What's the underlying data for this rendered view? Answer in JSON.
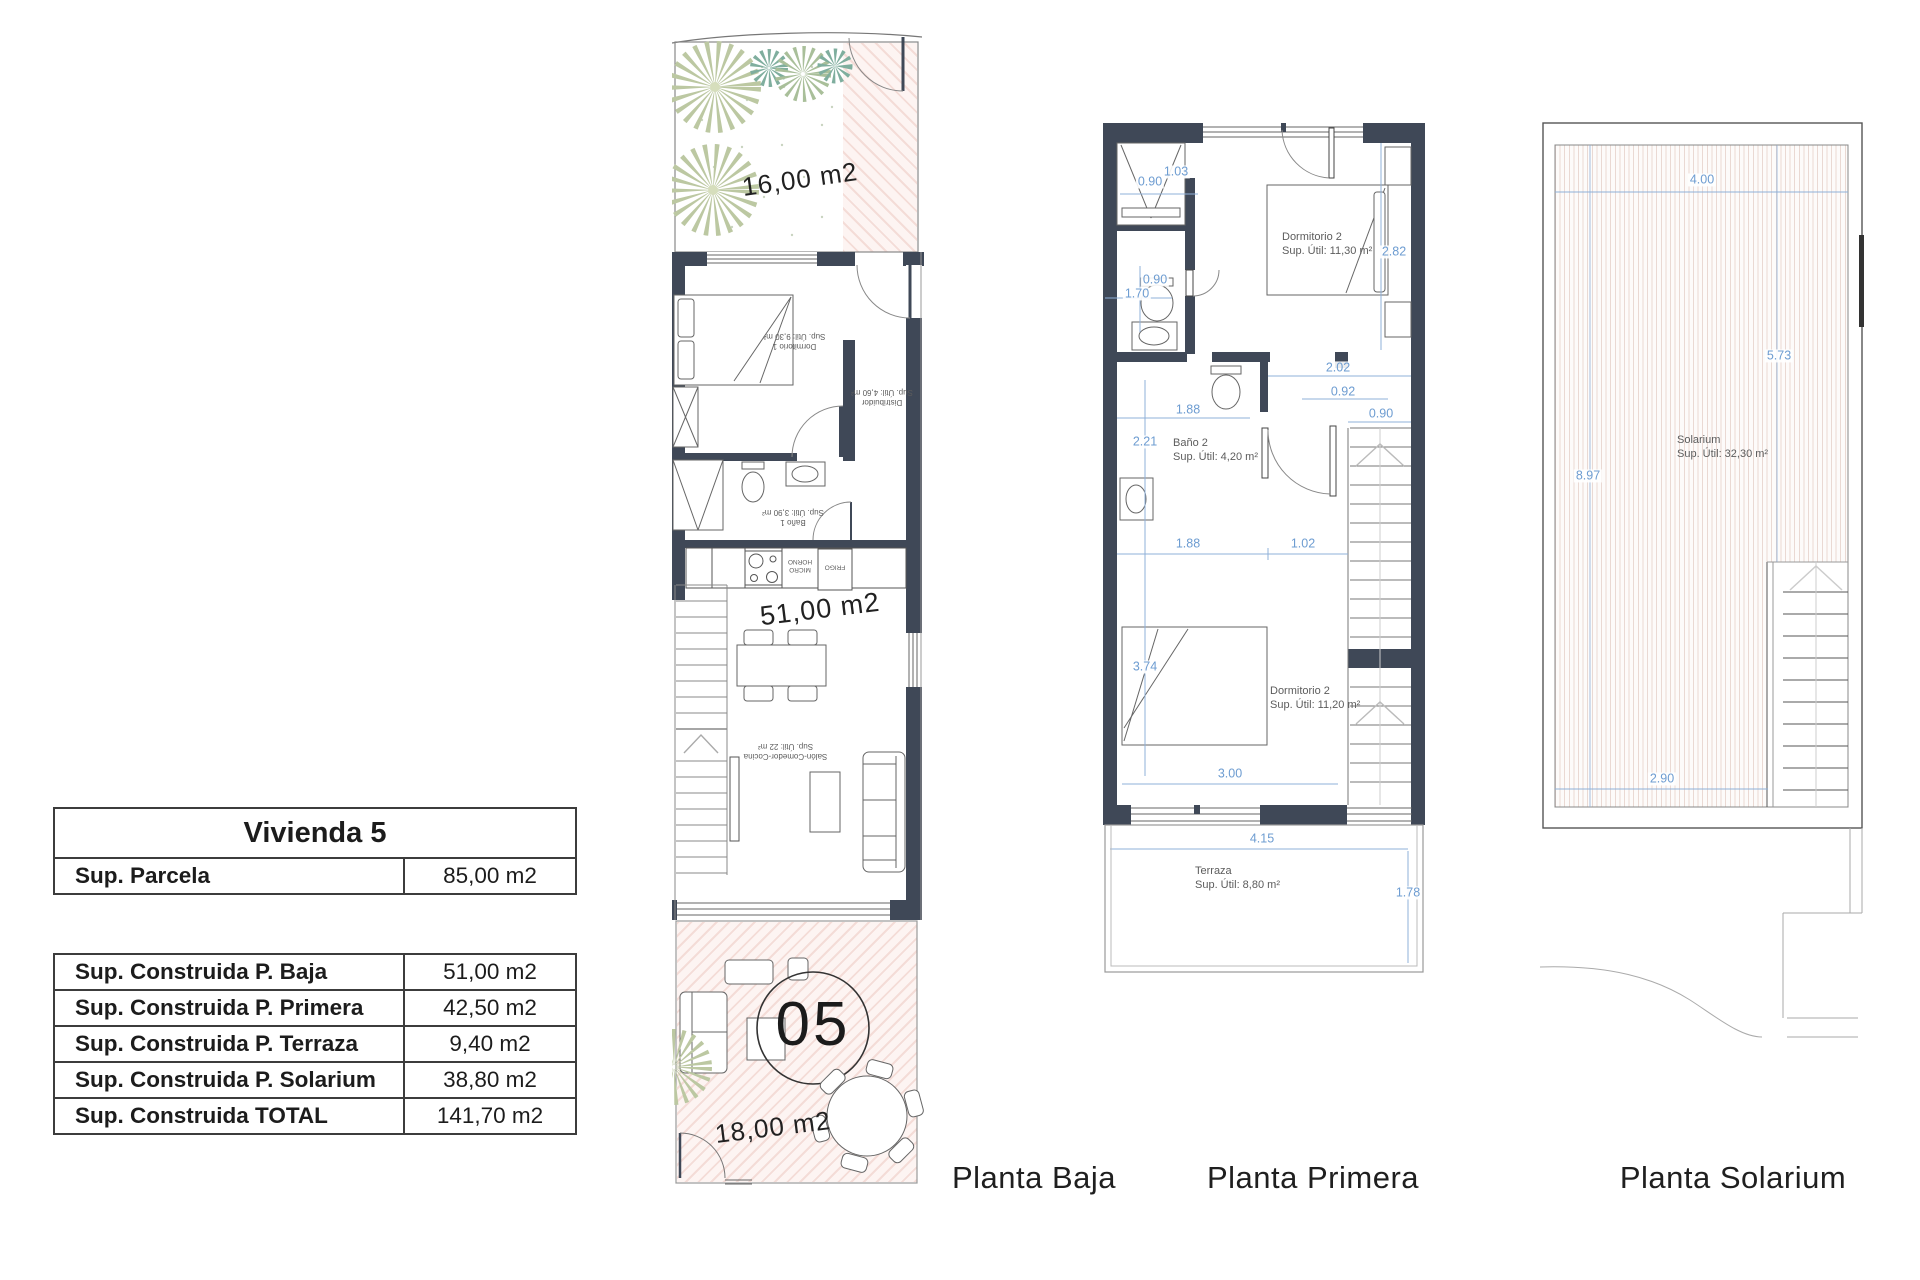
{
  "table_vivienda": {
    "title": "Vivienda 5",
    "parcela": {
      "label": "Sup. Parcela",
      "value": "85,00 m2"
    }
  },
  "table_superficies": {
    "rows": [
      {
        "label": "Sup. Construida P. Baja",
        "value": "51,00 m2"
      },
      {
        "label": "Sup. Construida P. Primera",
        "value": "42,50 m2"
      },
      {
        "label": "Sup. Construida P. Terraza",
        "value": "9,40 m2"
      },
      {
        "label": "Sup. Construida P. Solarium",
        "value": "38,80 m2"
      },
      {
        "label": "Sup. Construida TOTAL",
        "value": "141,70 m2"
      }
    ]
  },
  "plan_baja": {
    "caption": "Planta Baja",
    "garden_area": "16,00 m2",
    "floor_area": "51,00 m2",
    "terrace_area": "18,00 m2",
    "unit_number": "05",
    "rooms": {
      "dormitorio1": {
        "name": "Dormitorio 1",
        "area": "Sup. Útil: 9,30 m²"
      },
      "distribuidor": {
        "name": "Distribuidor",
        "area": "Sup. Útil: 4,60 m²"
      },
      "bano1": {
        "name": "Baño 1",
        "area": "Sup. Útil: 3,90 m²"
      },
      "salon": {
        "name": "Salón-Comedor-Cocina",
        "area": "Sup. Útil: 22 m²"
      }
    },
    "kitchen": {
      "micro_line1": "MICRO",
      "micro_line2": "HORNO",
      "frigo": "FRIGO"
    }
  },
  "plan_primera": {
    "caption": "Planta Primera",
    "rooms": {
      "dormitorio_top": {
        "name": "Dormitorio 2",
        "area": "Sup. Útil: 11,30 m²"
      },
      "bano2": {
        "name": "Baño 2",
        "area": "Sup. Útil: 4,20 m²"
      },
      "dormitorio_bottom": {
        "name": "Dormitorio 2",
        "area": "Sup. Útil: 11,20 m²"
      },
      "terraza": {
        "name": "Terraza",
        "area": "Sup. Útil: 8,80 m²"
      }
    },
    "dims": [
      "0.90",
      "1.03",
      "0.90",
      "1.70",
      "2.82",
      "2.02",
      "0.92",
      "0.90",
      "1.88",
      "2.21",
      "1.88",
      "1.02",
      "3.74",
      "3.00",
      "4.15",
      "1.78"
    ]
  },
  "plan_solarium": {
    "caption": "Planta Solarium",
    "room": {
      "name": "Solarium",
      "area": "Sup. Útil: 32,30 m²"
    },
    "dims": {
      "top": "4.00",
      "right": "5.73",
      "left": "8.97",
      "bottom": "2.90"
    }
  },
  "colors": {
    "wall": "#3f4857",
    "dimension_blue": "#6d9cd1",
    "hatch_pink_line": "#f4dcd7",
    "hatch_pink_bg": "#fdf4f2",
    "solarium_hatch_line": "#ead9d3",
    "tree_olive": "#bcc8a2",
    "tree_teal": "#7fae9e",
    "thin_line": "#888888"
  }
}
